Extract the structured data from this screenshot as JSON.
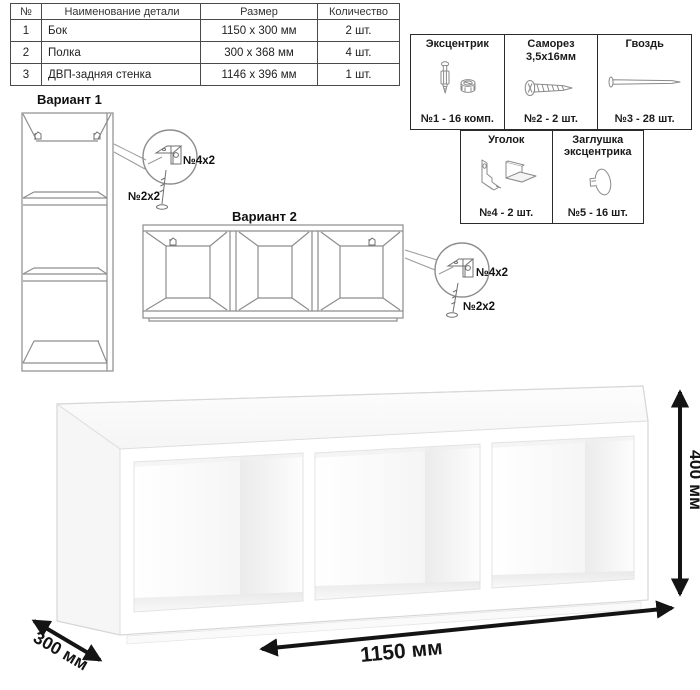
{
  "parts_table": {
    "headers": {
      "num": "№",
      "name": "Наименование детали",
      "size": "Размер",
      "qty": "Количество"
    },
    "rows": [
      {
        "num": "1",
        "name": "Бок",
        "size": "1150 x 300 мм",
        "qty": "2 шт."
      },
      {
        "num": "2",
        "name": "Полка",
        "size": "300 x 368 мм",
        "qty": "4 шт."
      },
      {
        "num": "3",
        "name": "ДВП-задняя стенка",
        "size": "1146 x 396 мм",
        "qty": "1 шт."
      }
    ]
  },
  "hardware": {
    "cells": [
      {
        "title": "Эксцентрик",
        "title2": "",
        "count": "№1 - 16 комп."
      },
      {
        "title": "Саморез",
        "title2": "3,5x16мм",
        "count": "№2 - 2 шт."
      },
      {
        "title": "Гвоздь",
        "title2": "",
        "count": "№3 - 28 шт."
      },
      {
        "title": "Уголок",
        "title2": "",
        "count": "№4 - 2 шт."
      },
      {
        "title": "Заглушка",
        "title2": "эксцентрика",
        "count": "№5 - 16 шт."
      }
    ]
  },
  "variant1": {
    "title": "Вариант 1",
    "bracket_label": "№4x2",
    "screw_label": "№2x2"
  },
  "variant2": {
    "title": "Вариант 2",
    "bracket_label": "№4x2",
    "screw_label": "№2x2"
  },
  "dimensions": {
    "width_label": "1150 мм",
    "depth_label": "300 мм",
    "height_label": "400 мм"
  }
}
